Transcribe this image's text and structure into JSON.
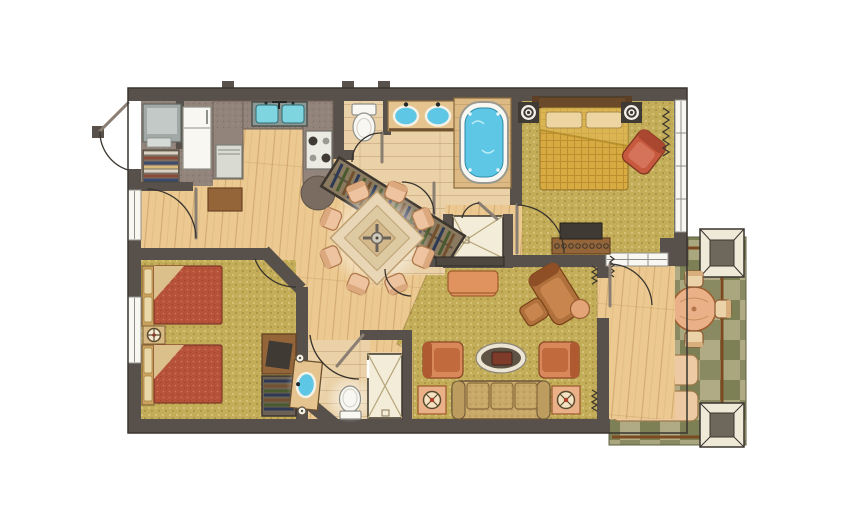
{
  "plan": {
    "type": "floor-plan",
    "description": "Two-bedroom two-bath resort suite floor plan with kitchen, dining area, living room, master suite with jetted tub, guest bedroom with two double beds, and tiled patio with columns",
    "rooms": [
      {
        "name": "entry",
        "features": [
          "entry-door"
        ]
      },
      {
        "name": "laundry-closet",
        "features": [
          "stacked-washer-dryer",
          "linen-shelves"
        ]
      },
      {
        "name": "kitchen",
        "features": [
          "double-sink",
          "four-burner-cooktop",
          "dishwasher",
          "refrigerator",
          "u-shaped-counter",
          "round-counter-end",
          "console-cabinet"
        ]
      },
      {
        "name": "dining-area",
        "features": [
          "square-dining-table",
          "eight-dining-chairs",
          "ceiling-fan"
        ]
      },
      {
        "name": "water-closet",
        "features": [
          "toilet"
        ]
      },
      {
        "name": "master-bathroom",
        "features": [
          "double-vanity",
          "jetted-tub",
          "walk-in-shower",
          "shower-bench",
          "walk-in-closet-with-hanging-clothes"
        ]
      },
      {
        "name": "master-bedroom",
        "features": [
          "bed",
          "two-speaker-nightstands",
          "armchair",
          "dresser-with-tv",
          "window",
          "slider-to-patio"
        ]
      },
      {
        "name": "guest-bedroom",
        "features": [
          "two-double-beds",
          "nightstand-with-lamp",
          "dresser-with-tv",
          "closet",
          "two-windows"
        ]
      },
      {
        "name": "guest-bathroom",
        "features": [
          "vanity-sink",
          "toilet",
          "shower-stall"
        ]
      },
      {
        "name": "living-room",
        "features": [
          "sofa",
          "two-armchairs",
          "oval-coffee-table",
          "chaise-lounge",
          "ottoman",
          "round-side-table",
          "two-end-tables-with-lamps",
          "tv-console",
          "upholstered-bench"
        ]
      },
      {
        "name": "patio",
        "features": [
          "round-table",
          "four-chairs",
          "two-chaise-lounges",
          "two-columns",
          "checker-tile-floor",
          "railing"
        ]
      }
    ]
  },
  "palette": {
    "wall": "#58514b",
    "walldark": "#39342e",
    "wood": "#ebc991",
    "carpet": "#c3ad58",
    "bathtile": "#ead1a7",
    "counter": "#92847a",
    "counterdark": "#7a6c60",
    "water": "#7ed5df",
    "tubwater": "#5ec7e5",
    "fixture": "#f8f7f1",
    "fixtureline": "#8f9089",
    "peach": "#eab189",
    "peachdark": "#a05e2f",
    "sofa": "#c9a96a",
    "redbed": "#b6523a",
    "goldbed": "#d8ab42",
    "brownwood": "#95653a",
    "darkitem": "#3f3a33",
    "colframe": "#efe9d8",
    "colcore": "#6e675c",
    "rail": "#7b4a20",
    "chairorange": "#d9885c",
    "chaisebrown": "#b0703c",
    "redchair": "#c75a3e"
  }
}
